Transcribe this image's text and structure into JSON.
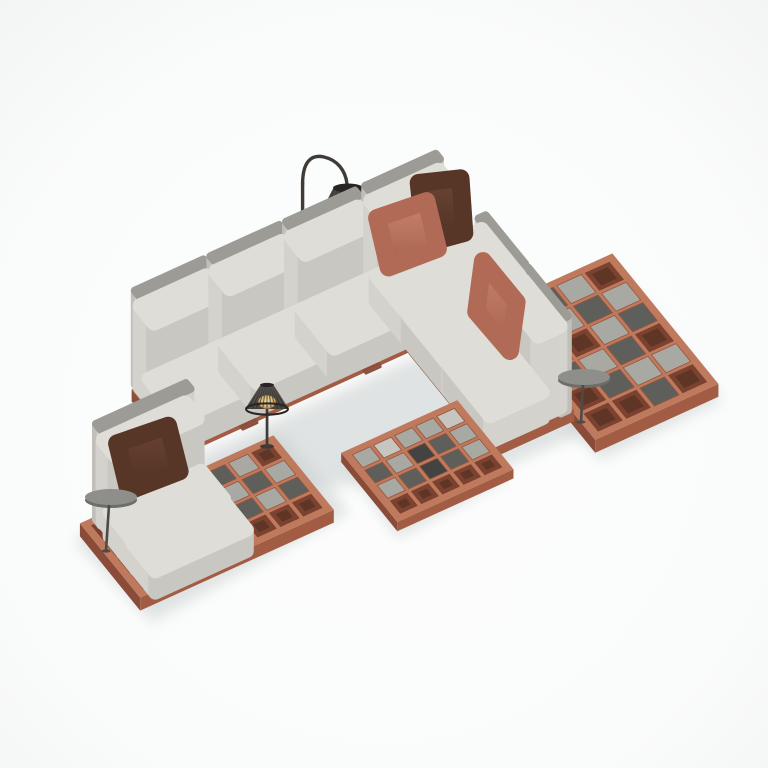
{
  "title": "Outdoor modular lounge set - 3D product render on white background",
  "background": "#fafbfb",
  "palette": {
    "floor_light": "#fcfdfd",
    "floor_edge": "#f4f5f5",
    "floor_shadow": "#c9cdcd",
    "terracotta_top": "#bf7a5e",
    "terracotta_front": "#a15c43",
    "terracotta_side": "#8a4c38",
    "terracotta_hole": "#7b4230",
    "terracotta_hole_dark": "#60structural3526",
    "hole_dark": "#5f3526",
    "tile_light": "#a9a9a3",
    "tile_dark": "#5e5e5b",
    "tile_black": "#434341",
    "tile_white": "#c6c5c0",
    "tile_stroke": "#96553d",
    "base_top": "#b97057",
    "base_front": "#a25c44",
    "base_side": "#8d4f3b",
    "cushion_top": "#dfddd8",
    "cushion_front": "#c9c7c2",
    "cushion_side": "#d4d2cd",
    "panel_front": "#d2d0cb",
    "panel_top": "#9d9b96",
    "panel_side": "#c1bfba",
    "pillow_rust": "#c5816a",
    "pillow_rust_dark": "#a5624d",
    "pillow_rust_mid": "#b06a55",
    "pillow_brown": "#6b4434",
    "pillow_brown_dark": "#4f3123",
    "pillow_brown_mid": "#573627",
    "lamp_body": "#3f3c38",
    "lamp_dark": "#262523",
    "lamp_rib": "#57534e",
    "lamp_glow": "#e2b96d",
    "lamp_glow_core": "#f7e7b2",
    "disc_top": "#8e8e8a",
    "disc_rim": "#6d6d69",
    "stem": "#4c4b47",
    "leg_light": "#cbcbc7",
    "leg_front": "#b8b8b4",
    "leg_side": "#a9a9a5"
  },
  "scene": {
    "description": "Isometric render of an outdoor lounge: L-shaped corner sofa and chaise lounge on terracotta lattice platforms inset with gray checkered tiles, accent pillows, arc floor lamp and solar table lamp with glowing wire shades, two round pedestal side tables, and a low checkered coffee table.",
    "objects": [
      {
        "name": "corner-sofa",
        "detail": "L-shaped, 5 seats plus corner, light gray cushions, tall backrest panels, terracotta base"
      },
      {
        "name": "chaise-lounge",
        "detail": "two-cushion daybed with backrest and brown lumbar pillow"
      },
      {
        "name": "chaise-platform",
        "detail": "terracotta lattice platform, checkered gray tiles, open front cells"
      },
      {
        "name": "right-lattice-platform",
        "detail": "terracotta lattice extension with checkered tiles"
      },
      {
        "name": "coffee-table",
        "detail": "low square table, terracotta grid top with light/dark/black tiles, open front row"
      },
      {
        "name": "accent-pillow-rust-corner",
        "detail": "salmon terracotta pillow at sofa corner"
      },
      {
        "name": "accent-pillow-brown-corner",
        "detail": "dark brown pillow at sofa corner"
      },
      {
        "name": "accent-pillow-rust-right",
        "detail": "salmon terracotta pillow on right wing"
      },
      {
        "name": "lumbar-pillow-brown",
        "detail": "dark brown pillow on chaise"
      },
      {
        "name": "floor-lamp",
        "detail": "black arc floor lamp, ribbed cage shade, warm glowing bulb"
      },
      {
        "name": "table-lamp",
        "detail": "small black cage lamp, warm glow, on lattice platform"
      },
      {
        "name": "side-table-left",
        "detail": "round gray pedestal tray over chaise seat"
      },
      {
        "name": "side-table-right",
        "detail": "round gray pedestal tray at sofa end"
      }
    ]
  }
}
